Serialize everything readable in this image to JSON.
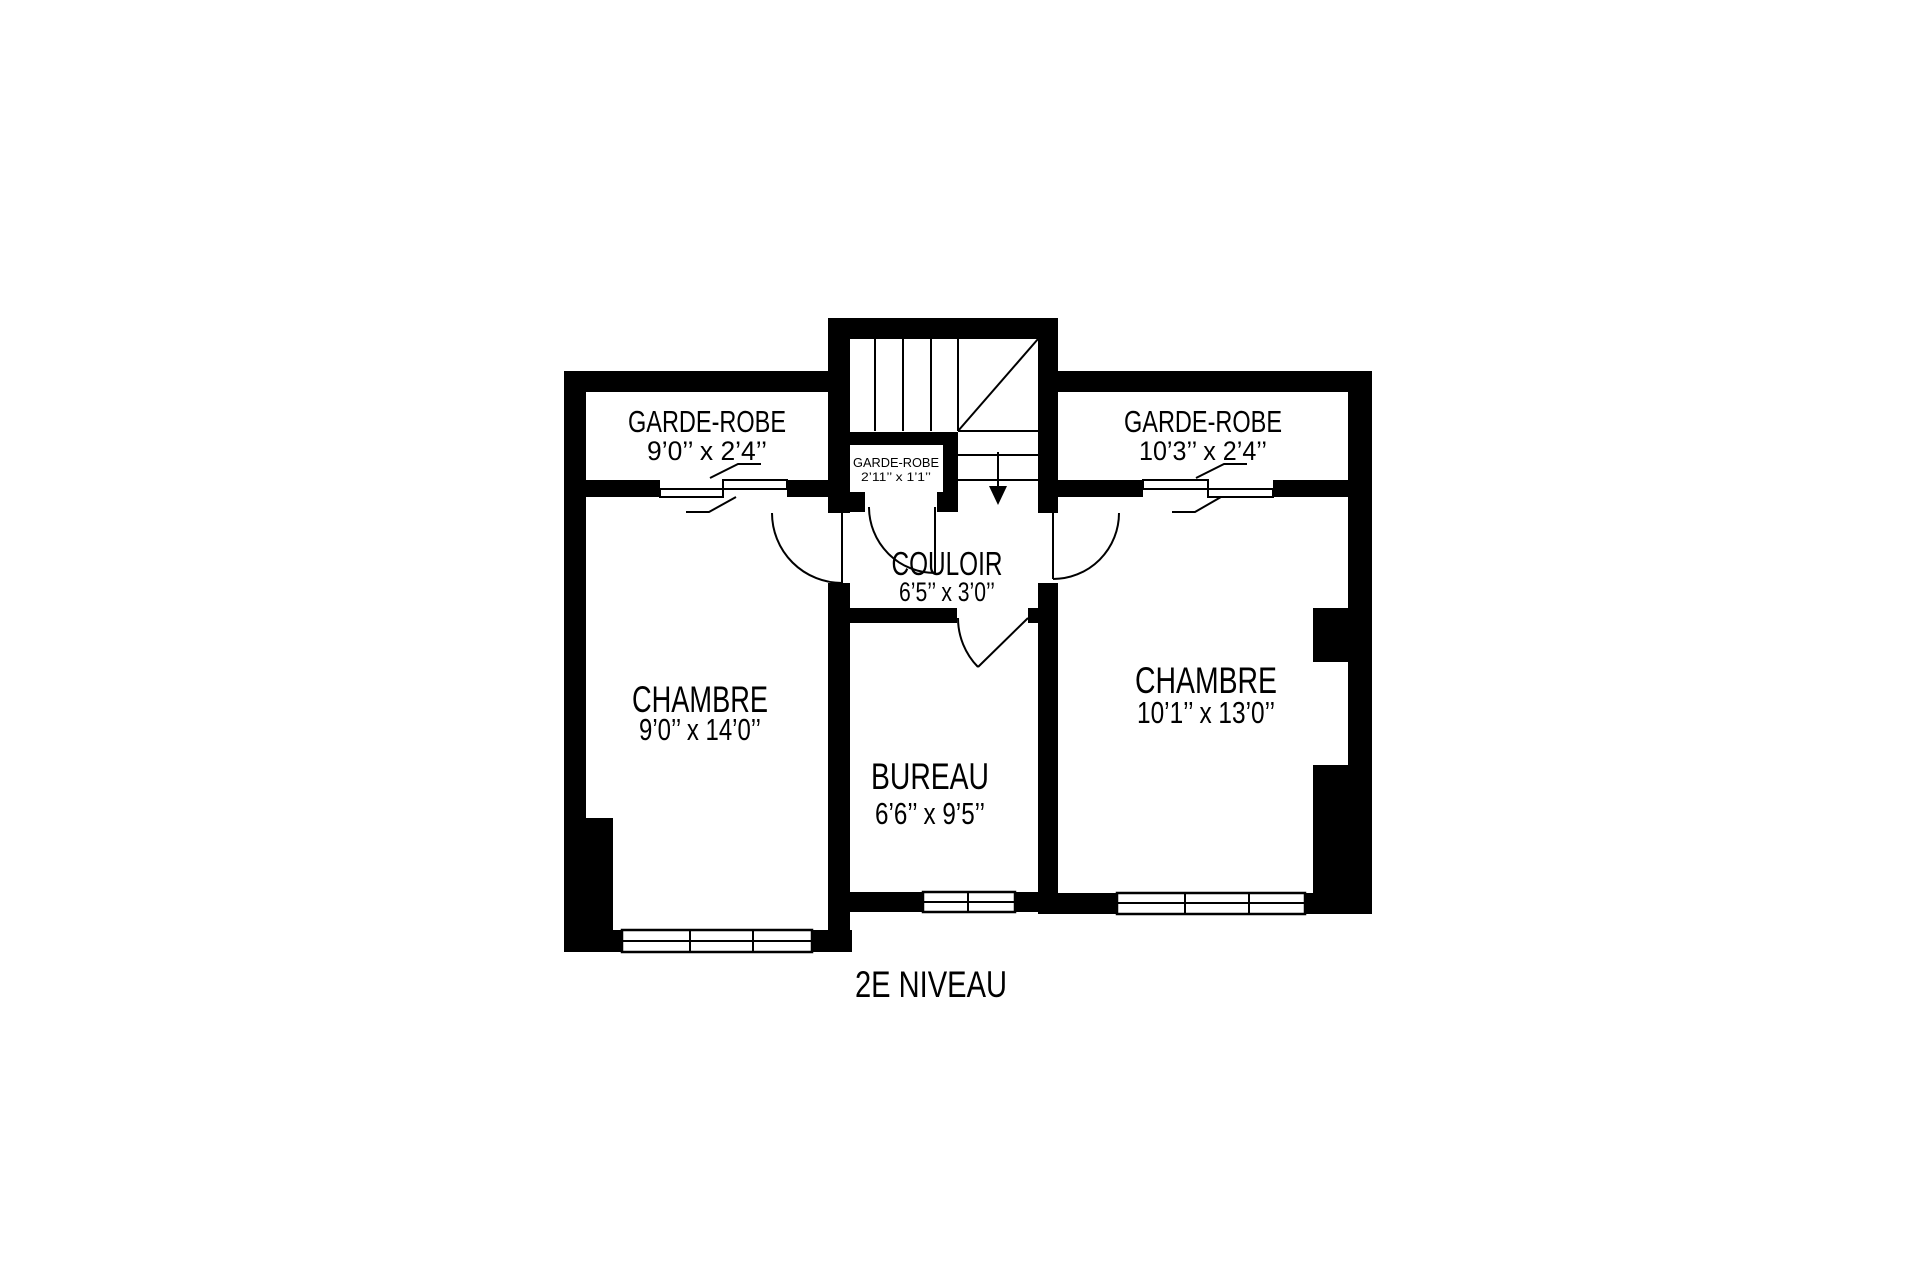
{
  "title": "2E NIVEAU",
  "rooms": {
    "garde_robe_left": {
      "name": "GARDE-ROBE",
      "dims": "9’0’’ x 2’4’’"
    },
    "garde_robe_right": {
      "name": "GARDE-ROBE",
      "dims": "10’3’’ x 2’4’’"
    },
    "garde_robe_small": {
      "name": "GARDE-ROBE",
      "dims": "2’11’’ x 1’1’’"
    },
    "couloir": {
      "name": "COULOIR",
      "dims": "6’5’’ x 3’0’’"
    },
    "chambre_left": {
      "name": "CHAMBRE",
      "dims": "9’0’’ x 14’0’’"
    },
    "bureau": {
      "name": "BUREAU",
      "dims": "6’6’’ x 9’5’’"
    },
    "chambre_right": {
      "name": "CHAMBRE",
      "dims": "10’1’’ x 13’0’’"
    }
  },
  "colors": {
    "wall": "#000000",
    "background": "#ffffff",
    "line": "#000000"
  }
}
